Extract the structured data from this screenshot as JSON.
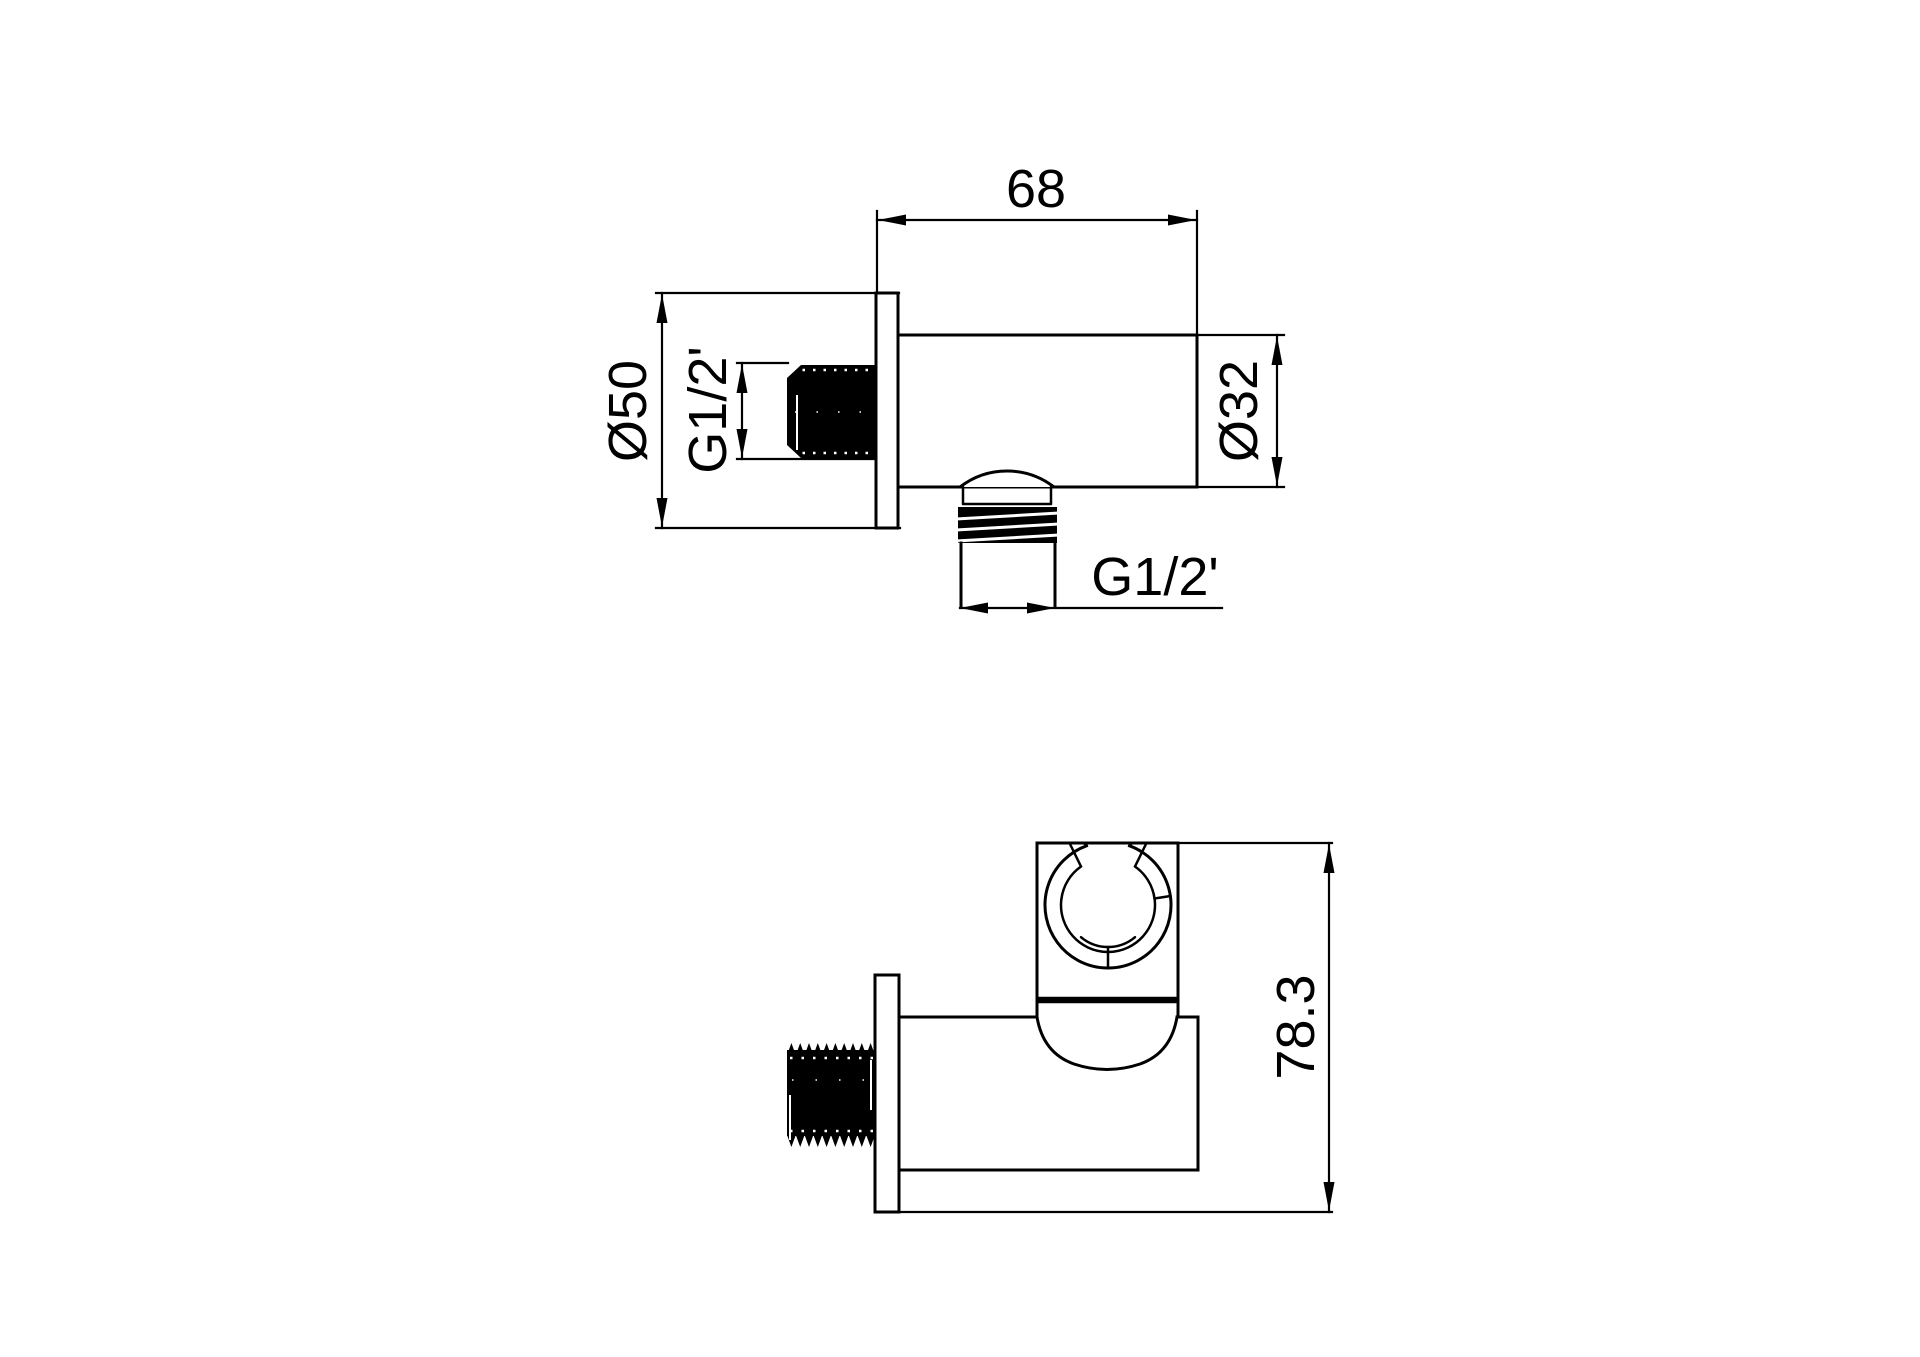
{
  "drawing": {
    "type": "technical-dimension-drawing",
    "subject": "shower wall outlet elbow with hand-shower holder, two orthographic views",
    "background_color": "#ffffff",
    "line_color": "#000000",
    "labels": {
      "top_width": "68",
      "flange_diameter": "Ø50",
      "inlet_thread": "G1/2'",
      "body_diameter": "Ø32",
      "outlet_thread": "G1/2'",
      "overall_height": "78.3"
    }
  }
}
